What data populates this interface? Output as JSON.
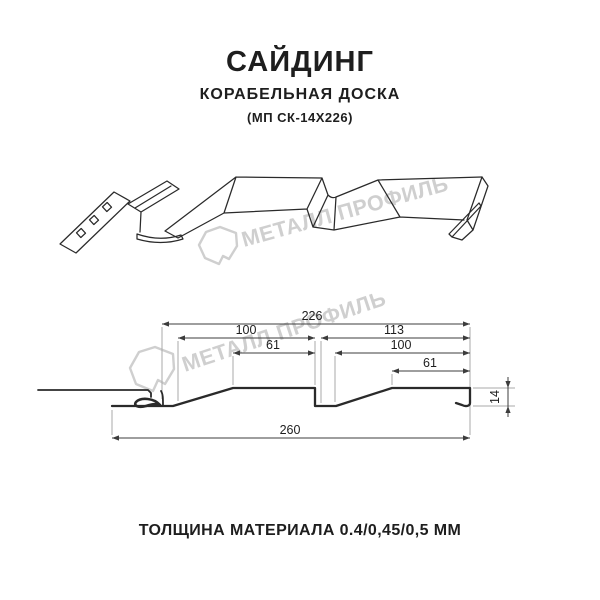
{
  "header": {
    "title": "САЙДИНГ",
    "subtitle": "КОРАБЕЛЬНАЯ ДОСКА",
    "code": "(МП СК-14Х226)"
  },
  "watermark": {
    "brand": "МЕТАЛЛ ПРОФИЛЬ",
    "logo_icon": "metall-profil-gem-outline"
  },
  "drawing": {
    "dims": {
      "total_width": "226",
      "left_pitch": "100",
      "right_pitch": "113",
      "left_flat": "61",
      "right_slope_flat": "100",
      "right_flat": "61",
      "overall_width": "260",
      "profile_height": "14"
    }
  },
  "footer": {
    "thickness": "ТОЛЩИНА МАТЕРИАЛА 0.4/0,45/0,5 ММ"
  },
  "colors": {
    "ink": "#1e1e1e",
    "line": "#2a2a2a",
    "dim-line": "#3c3c3c",
    "extension": "#a9a9a9",
    "watermark": "#cfcfcf",
    "bg": "#ffffff"
  }
}
